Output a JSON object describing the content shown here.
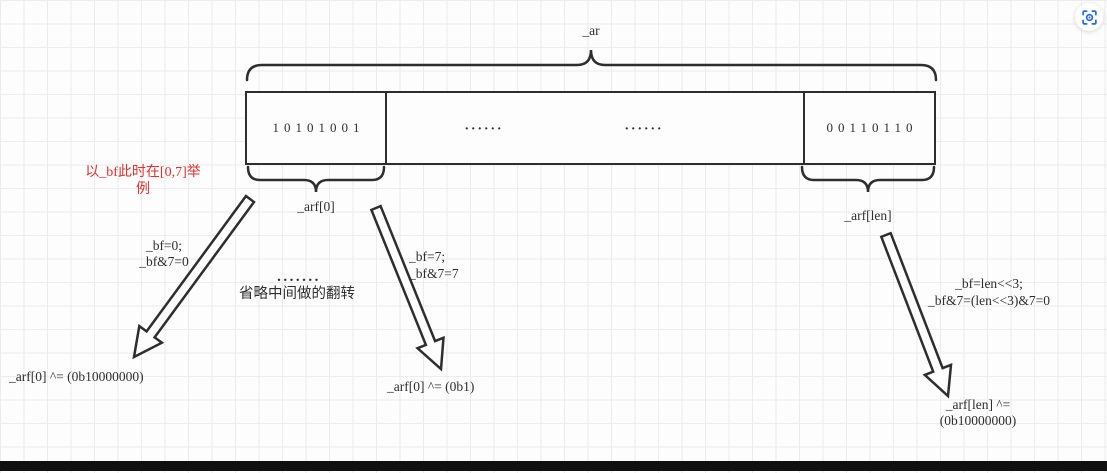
{
  "labels": {
    "array": "_ar",
    "first_byte": "_arf[0]",
    "last_byte": "_arf[len]"
  },
  "cells": {
    "first_bits": "10101001",
    "middle_dots_a": "......",
    "middle_dots_b": "......",
    "last_bits": "00110110"
  },
  "notes": {
    "example_red_line1": "以_bf此时在[0,7]举",
    "example_red_line2": "例",
    "ellipsis": ".......",
    "skip_middle": "省略中间做的翻转"
  },
  "cases": {
    "first": {
      "expr1": "_bf=0;",
      "expr2": "_bf&7=0",
      "result": "_arf[0] ^= (0b10000000)"
    },
    "middle": {
      "expr1": "_bf=7;",
      "expr2": "_bf&7=7",
      "result": "_arf[0] ^= (0b1)"
    },
    "last": {
      "expr1": "_bf=len<<3;",
      "expr2": "_bf&7=(len<<3)&7=0",
      "result_line1": "_arf[len] ^=",
      "result_line2": "(0b10000000)"
    }
  },
  "colors": {
    "ink": "#2e2e2e",
    "red": "#e03030",
    "blue": "#2468e8",
    "grid": "#ececec",
    "background": "#fdfdfd"
  },
  "icons": {
    "scan": "scan-ocr-icon"
  }
}
